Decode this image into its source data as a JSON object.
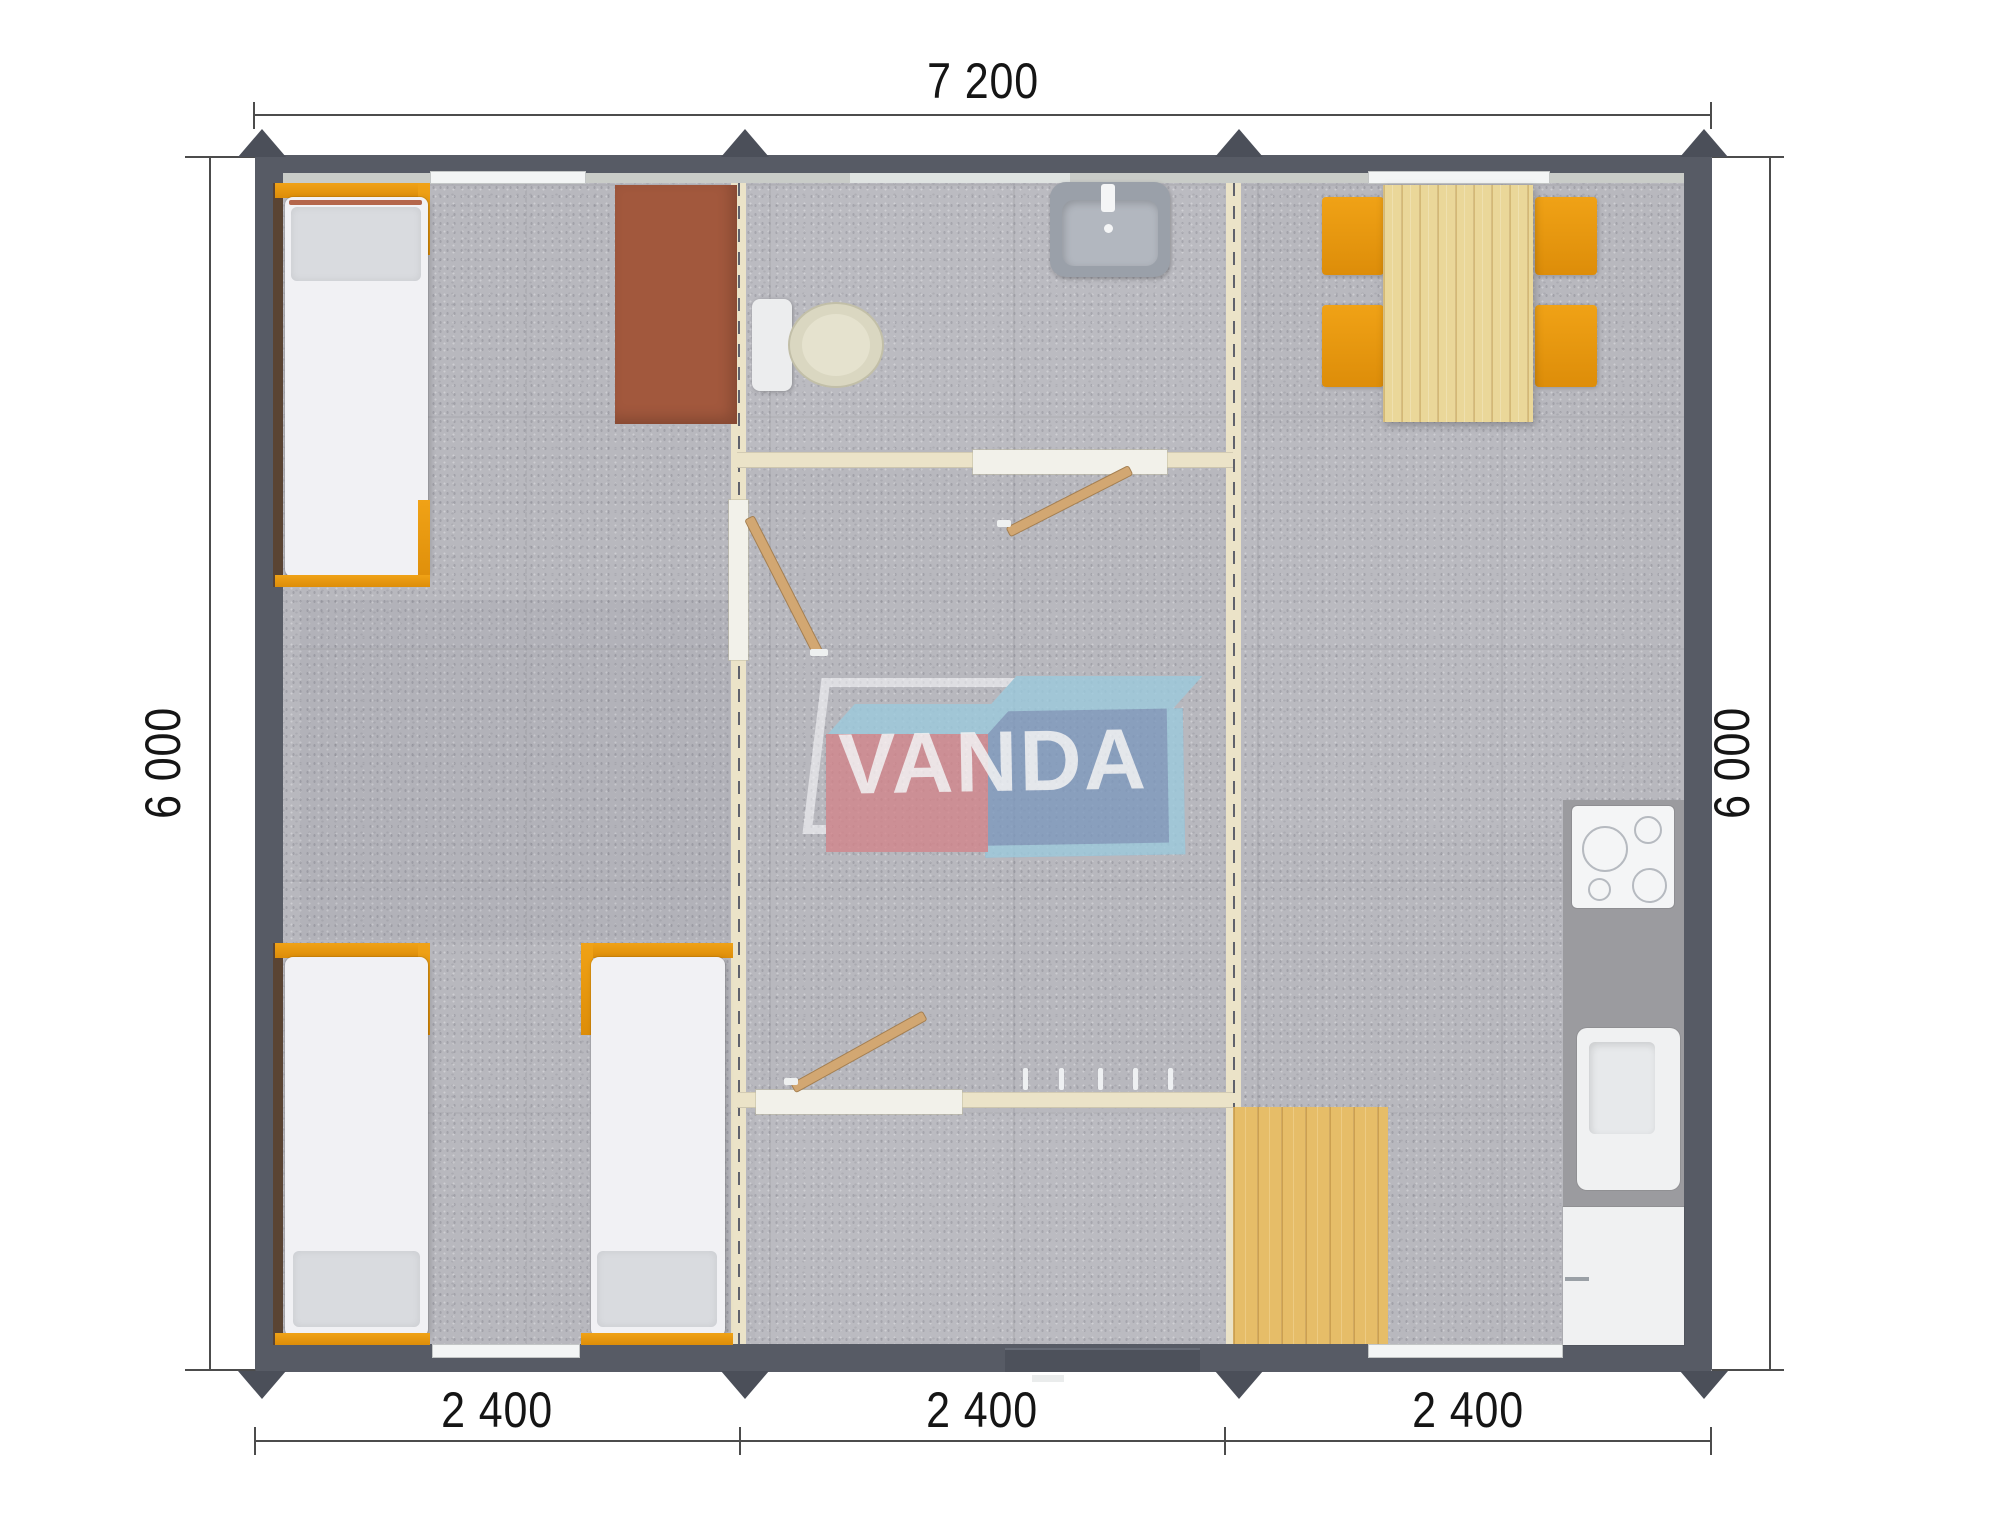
{
  "plan": {
    "type": "modular-building-floor-plan",
    "dimensions": {
      "top": "7 200",
      "left": "6 000",
      "right": "6 000",
      "bottom": [
        "2 400",
        "2 400",
        "2 400"
      ]
    },
    "watermark": {
      "text": "VANDA"
    },
    "colors": {
      "wall": "#575b65",
      "floor": "#b8b8be",
      "partition": "#ebe3c8",
      "furniture_orange": "#e8950f",
      "desk_brown": "#a2583d",
      "wood_table": "#ead799",
      "wood_floor": "#e6bd68",
      "logo_red": "#d2858b",
      "logo_blue": "#7e99bd",
      "logo_light_blue": "#9ccadd"
    },
    "modules": [
      {
        "name": "bedroom-module",
        "furniture": [
          "single-bed",
          "single-bed",
          "single-bed",
          "desk"
        ]
      },
      {
        "name": "bathroom-hall-module",
        "furniture": [
          "toilet",
          "washbasin",
          "interior-door",
          "interior-door",
          "interior-door",
          "coat-hooks"
        ]
      },
      {
        "name": "kitchen-dining-module",
        "furniture": [
          "dining-table",
          "chair",
          "chair",
          "chair",
          "chair",
          "cooktop",
          "kitchen-sink",
          "cabinet",
          "entry-mat"
        ]
      }
    ]
  }
}
